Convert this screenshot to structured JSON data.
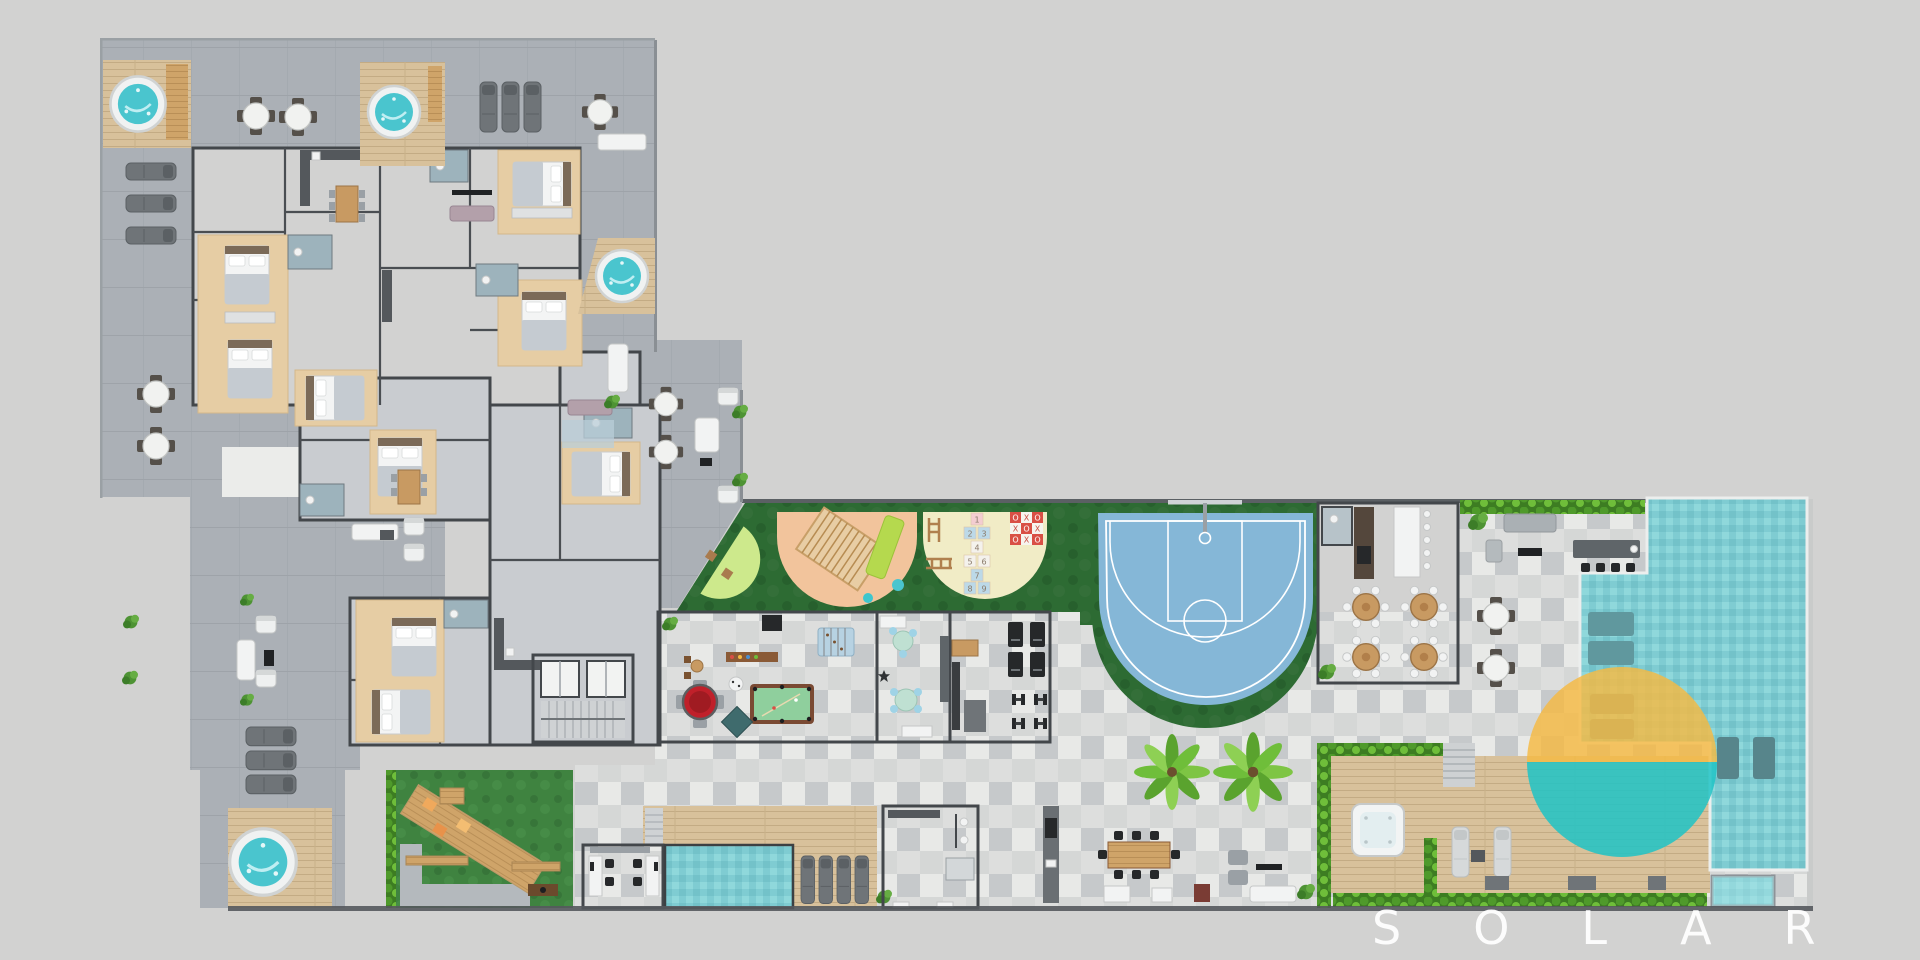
{
  "watermark": {
    "text": "SOLAR"
  },
  "palette": {
    "bg": "#d2d2d1",
    "roof": "#ebecea",
    "terrace": "#abb0b6",
    "interior": "#c9ccd0",
    "wall": "#43474b",
    "wood": "#cfa469",
    "deck": "#d8c19b",
    "lawn": "#3f8340",
    "turf": "#2d6b33",
    "lime": "#cde98c",
    "peach": "#f2c49c",
    "cream": "#f1ecc6",
    "court": "#85b7d7",
    "court_line": "#ffffff",
    "water": "#4ac5ce",
    "pool": "#7fccd2",
    "spa": "#aee7e9",
    "sun_orange": "#f5b942",
    "sun_teal": "#1fc3c5",
    "hedge": "#4f9a2b",
    "palm": "#7ec544",
    "checker_a": "#e8e9e7",
    "checker_b": "#c6c9cb",
    "poker": "#c0202a",
    "billiard": "#8fcf9d",
    "watermark": "#ffffff"
  },
  "playground": {
    "hopscotch": [
      "1",
      "2",
      "3",
      "4",
      "5",
      "6",
      "7",
      "8",
      "9"
    ],
    "ttt_marks": [
      "O",
      "X",
      "O",
      "X",
      "O",
      "X",
      "O",
      "X",
      "O"
    ]
  }
}
